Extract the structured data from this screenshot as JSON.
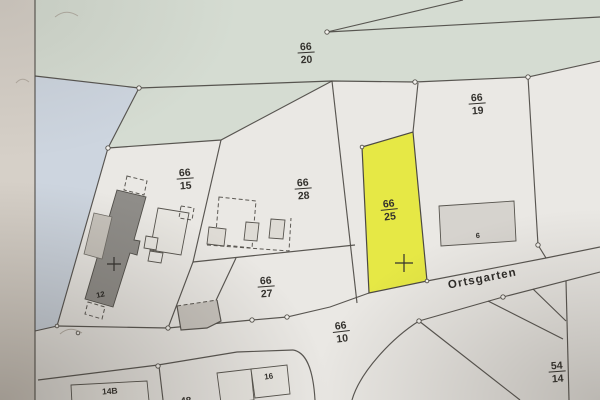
{
  "photo": {
    "street_label": "Ortsgarten",
    "parcel_labels": {
      "p66_20": {
        "num": "66",
        "den": "20"
      },
      "p66_19": {
        "num": "66",
        "den": "19"
      },
      "p66_15": {
        "num": "66",
        "den": "15"
      },
      "p66_28": {
        "num": "66",
        "den": "28"
      },
      "p66_25": {
        "num": "66",
        "den": "25"
      },
      "p66_27": {
        "num": "66",
        "den": "27"
      },
      "p66_10": {
        "num": "66",
        "den": "10"
      },
      "p54_14": {
        "num": "54",
        "den": "14"
      }
    },
    "building_labels": {
      "b12": "12",
      "b6": "6",
      "b14B": "14B",
      "b16": "16",
      "b48": "48"
    },
    "highlighted_parcel": {
      "label": "66/25",
      "color": "#e6e845"
    },
    "colors": {
      "paper": "#d6d0c8",
      "parcel_white": "#eae8e4",
      "green_area": "#d5dcd2",
      "blue_area": "#cdd5df",
      "highlight_yellow": "#e6e845",
      "building_dark": "#8f8d89",
      "building_light": "#d6d3ce",
      "line": "#4c4944"
    }
  }
}
